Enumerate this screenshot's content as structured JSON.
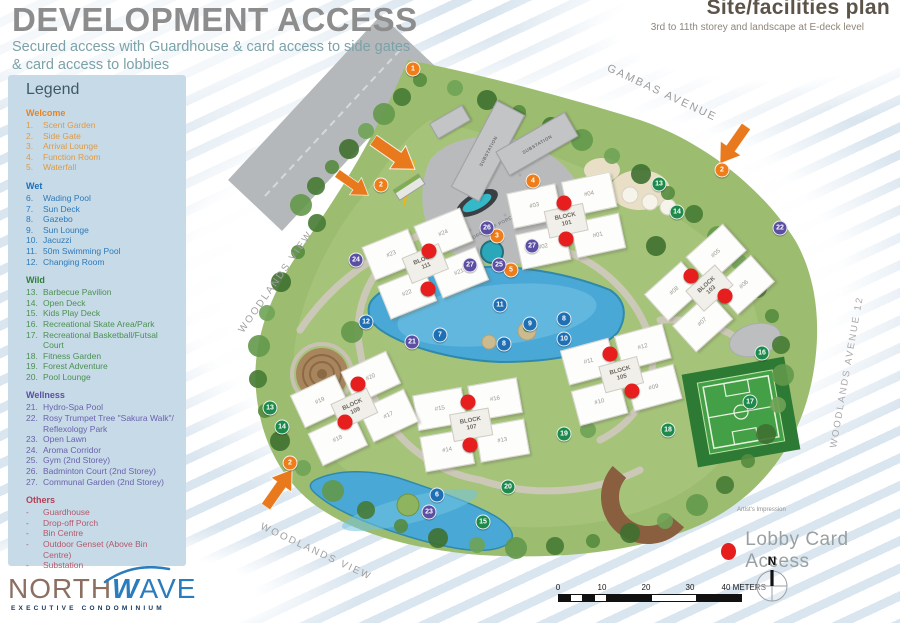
{
  "header": {
    "title": "DEVELOPMENT ACCESS",
    "subtitle_line1": "Secured access with Guardhouse & card access to side gates",
    "subtitle_line2": "& card access to lobbies"
  },
  "plan_header": {
    "title": "Site/facilities plan",
    "subtitle": "3rd to 11th storey and landscape at E-deck level"
  },
  "legend": {
    "title": "Legend",
    "sections": [
      {
        "name": "Welcome",
        "head_color": "#e8831d",
        "item_color": "#dd9a45",
        "items": [
          {
            "n": "1.",
            "label": "Scent Garden"
          },
          {
            "n": "2.",
            "label": "Side Gate"
          },
          {
            "n": "3.",
            "label": "Arrival Lounge"
          },
          {
            "n": "4.",
            "label": "Function Room"
          },
          {
            "n": "5.",
            "label": "Waterfall"
          }
        ]
      },
      {
        "name": "Wet",
        "head_color": "#1b6fb5",
        "item_color": "#2c7ab8",
        "items": [
          {
            "n": "6.",
            "label": "Wading Pool"
          },
          {
            "n": "7.",
            "label": "Sun Deck"
          },
          {
            "n": "8.",
            "label": "Gazebo"
          },
          {
            "n": "9.",
            "label": "Sun Lounge"
          },
          {
            "n": "10.",
            "label": "Jacuzzi"
          },
          {
            "n": "11.",
            "label": "50m Swimming Pool"
          },
          {
            "n": "12.",
            "label": "Changing Room"
          }
        ]
      },
      {
        "name": "Wild",
        "head_color": "#2f8038",
        "item_color": "#4a9150",
        "items": [
          {
            "n": "13.",
            "label": "Barbecue Pavilion"
          },
          {
            "n": "14.",
            "label": "Open Deck"
          },
          {
            "n": "15.",
            "label": "Kids Play Deck"
          },
          {
            "n": "16.",
            "label": "Recreational Skate Area/Park"
          },
          {
            "n": "17.",
            "label": "Recreational Basketball/Futsal Court"
          },
          {
            "n": "18.",
            "label": "Fitness Garden"
          },
          {
            "n": "19.",
            "label": "Forest Adventure"
          },
          {
            "n": "20.",
            "label": "Pool Lounge"
          }
        ]
      },
      {
        "name": "Wellness",
        "head_color": "#5950a0",
        "item_color": "#6a62ab",
        "items": [
          {
            "n": "21.",
            "label": "Hydro-Spa Pool"
          },
          {
            "n": "22.",
            "label": "Rosy Trumpet Tree \"Sakura Walk\"/ Reflexology Park"
          },
          {
            "n": "23.",
            "label": "Open Lawn"
          },
          {
            "n": "24.",
            "label": "Aroma Corridor"
          },
          {
            "n": "25.",
            "label": "Gym (2nd Storey)"
          },
          {
            "n": "26.",
            "label": "Badminton Court (2nd Storey)"
          },
          {
            "n": "27.",
            "label": "Communal Garden (2nd Storey)"
          }
        ]
      },
      {
        "name": "Others",
        "head_color": "#b24055",
        "item_color": "#b25a6b",
        "items": [
          {
            "n": "-",
            "label": "Guardhouse"
          },
          {
            "n": "-",
            "label": "Drop-off Porch"
          },
          {
            "n": "-",
            "label": "Bin Centre"
          },
          {
            "n": "-",
            "label": "Outdoor Genset  (Above Bin Centre)"
          },
          {
            "n": "-",
            "label": "Substation"
          }
        ]
      }
    ]
  },
  "logo": {
    "north": "NORTH",
    "wave_w": "W",
    "wave_rest": "AVE",
    "tagline": "EXECUTIVE CONDOMINIUM"
  },
  "map": {
    "block_word": "BLOCK",
    "substation_label": "SUBSTATION",
    "dropoff_label": "DROP-OFF PORCH",
    "artists_impression": "Artist's Impression",
    "lobby_key_label": "Lobby Card Access",
    "north_letter": "N",
    "blocks": [
      {
        "num": "101",
        "x": 565,
        "y": 220,
        "rot": -12,
        "units": [
          "#03",
          "#04",
          "#02",
          "#01"
        ]
      },
      {
        "num": "103",
        "x": 708,
        "y": 288,
        "rot": -42,
        "units": [
          "#08",
          "#05",
          "#07",
          "#06"
        ]
      },
      {
        "num": "105",
        "x": 620,
        "y": 374,
        "rot": -15,
        "units": [
          "#11",
          "#12",
          "#10",
          "#09"
        ]
      },
      {
        "num": "107",
        "x": 470,
        "y": 424,
        "rot": -10,
        "units": [
          "#15",
          "#16",
          "#14",
          "#13"
        ]
      },
      {
        "num": "109",
        "x": 353,
        "y": 408,
        "rot": -25,
        "units": [
          "#19",
          "#20",
          "#18",
          "#17"
        ]
      },
      {
        "num": "111",
        "x": 424,
        "y": 263,
        "rot": -22,
        "units": [
          "#23",
          "#24",
          "#22",
          "#21"
        ]
      }
    ],
    "lobby_dots": [
      [
        564,
        203
      ],
      [
        566,
        239
      ],
      [
        691,
        276
      ],
      [
        725,
        296
      ],
      [
        610,
        354
      ],
      [
        632,
        391
      ],
      [
        468,
        402
      ],
      [
        470,
        445
      ],
      [
        358,
        384
      ],
      [
        345,
        422
      ],
      [
        429,
        251
      ],
      [
        428,
        289
      ]
    ],
    "markers": [
      {
        "n": "1",
        "c": "o",
        "x": 413,
        "y": 69
      },
      {
        "n": "2",
        "c": "o",
        "x": 381,
        "y": 185
      },
      {
        "n": "2",
        "c": "o",
        "x": 722,
        "y": 170
      },
      {
        "n": "2",
        "c": "o",
        "x": 290,
        "y": 463
      },
      {
        "n": "3",
        "c": "o",
        "x": 497,
        "y": 236
      },
      {
        "n": "4",
        "c": "o",
        "x": 533,
        "y": 181
      },
      {
        "n": "5",
        "c": "o",
        "x": 511,
        "y": 270
      },
      {
        "n": "6",
        "c": "b",
        "x": 437,
        "y": 495
      },
      {
        "n": "7",
        "c": "b",
        "x": 440,
        "y": 335
      },
      {
        "n": "8",
        "c": "b",
        "x": 504,
        "y": 344
      },
      {
        "n": "8",
        "c": "b",
        "x": 564,
        "y": 319
      },
      {
        "n": "9",
        "c": "b",
        "x": 530,
        "y": 324
      },
      {
        "n": "10",
        "c": "b",
        "x": 564,
        "y": 339
      },
      {
        "n": "11",
        "c": "b",
        "x": 500,
        "y": 305
      },
      {
        "n": "12",
        "c": "b",
        "x": 366,
        "y": 322
      },
      {
        "n": "13",
        "c": "g",
        "x": 659,
        "y": 184
      },
      {
        "n": "13",
        "c": "g",
        "x": 270,
        "y": 408
      },
      {
        "n": "14",
        "c": "g",
        "x": 677,
        "y": 212
      },
      {
        "n": "14",
        "c": "g",
        "x": 282,
        "y": 427
      },
      {
        "n": "15",
        "c": "g",
        "x": 483,
        "y": 522
      },
      {
        "n": "16",
        "c": "g",
        "x": 762,
        "y": 353
      },
      {
        "n": "17",
        "c": "g",
        "x": 750,
        "y": 402
      },
      {
        "n": "18",
        "c": "g",
        "x": 668,
        "y": 430
      },
      {
        "n": "19",
        "c": "g",
        "x": 564,
        "y": 434
      },
      {
        "n": "20",
        "c": "g",
        "x": 508,
        "y": 487
      },
      {
        "n": "21",
        "c": "p",
        "x": 412,
        "y": 342
      },
      {
        "n": "22",
        "c": "p",
        "x": 780,
        "y": 228
      },
      {
        "n": "23",
        "c": "p",
        "x": 429,
        "y": 512
      },
      {
        "n": "24",
        "c": "p",
        "x": 356,
        "y": 260
      },
      {
        "n": "25",
        "c": "p",
        "x": 499,
        "y": 265
      },
      {
        "n": "26",
        "c": "p",
        "x": 487,
        "y": 228
      },
      {
        "n": "27",
        "c": "p",
        "x": 470,
        "y": 265
      },
      {
        "n": "27",
        "c": "p",
        "x": 532,
        "y": 246
      }
    ],
    "marker_colors": {
      "o": "#ef7d1a",
      "b": "#1f6fb5",
      "g": "#1d8a4c",
      "p": "#5a4fa2"
    },
    "arrows": [
      {
        "x": 393,
        "y": 157,
        "rot": 35,
        "s": 1.0
      },
      {
        "x": 352,
        "y": 186,
        "rot": 35,
        "s": 0.75
      },
      {
        "x": 731,
        "y": 144,
        "rot": 125,
        "s": 0.9
      },
      {
        "x": 281,
        "y": 489,
        "rot": -55,
        "s": 0.9
      }
    ],
    "road_labels": [
      {
        "t": "GAMBAS AVENUE",
        "x": 662,
        "y": 93,
        "rot": 25,
        "fs": 11,
        "c": "#9b9b9b"
      },
      {
        "t": "WOODLANDS AVENUE 12",
        "x": 847,
        "y": 372,
        "rot": -80,
        "fs": 9.5,
        "c": "#a8a8a8"
      },
      {
        "t": "WOODLANDS VIEW",
        "x": 276,
        "y": 282,
        "rot": -55,
        "fs": 10,
        "c": "#a0a0a0"
      },
      {
        "t": "WOODLANDS VIEW",
        "x": 316,
        "y": 552,
        "rot": 25,
        "fs": 10,
        "c": "#a0a0a0"
      }
    ],
    "substations": [
      {
        "x": 487,
        "y": 150,
        "w": 96,
        "h": 30,
        "rot": -62,
        "labeled": true
      },
      {
        "x": 536,
        "y": 143,
        "w": 78,
        "h": 26,
        "rot": -30,
        "labeled": true
      },
      {
        "x": 449,
        "y": 121,
        "w": 36,
        "h": 16,
        "rot": -30,
        "labeled": false
      }
    ],
    "scale_ticks": [
      "0",
      "10",
      "20",
      "30",
      "40 METERS"
    ]
  }
}
